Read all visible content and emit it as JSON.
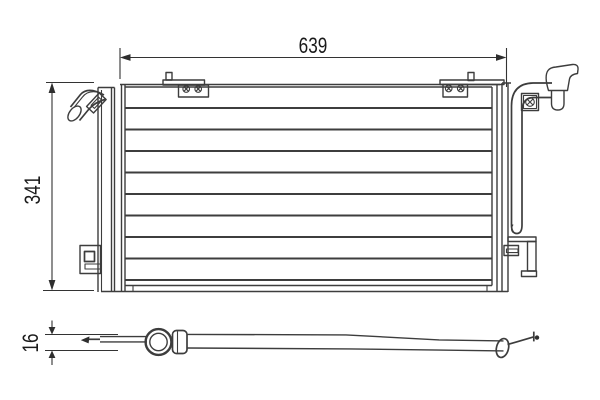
{
  "diagram": {
    "dimension_labels": {
      "width": "639",
      "height": "341",
      "thickness": "16"
    },
    "colors": {
      "line": "#3d3d3d",
      "text": "#1a1a1a",
      "background": "#ffffff"
    }
  }
}
